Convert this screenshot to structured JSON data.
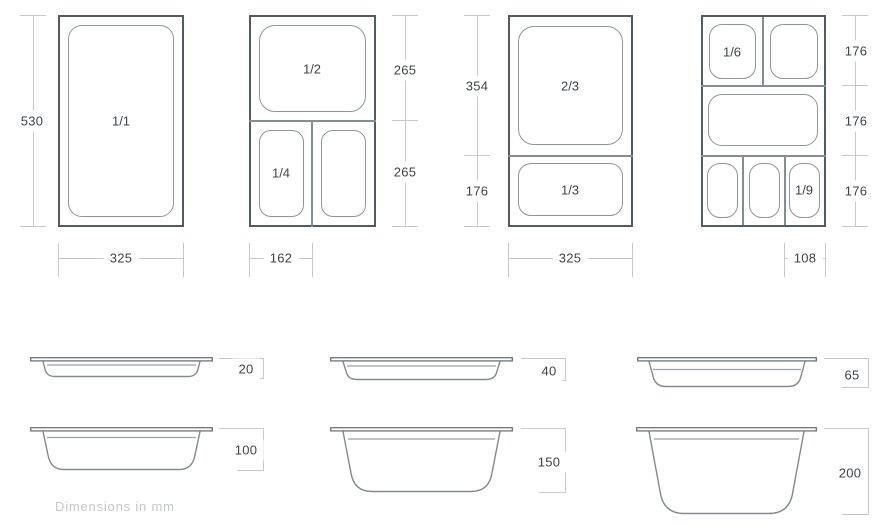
{
  "units_note": "Dimensions in mm",
  "top_views": [
    {
      "pan_labels": [
        "1/1"
      ],
      "vertical_dims": [
        "530"
      ],
      "bottom_dim": "325",
      "dim_side": "left"
    },
    {
      "pan_labels": [
        "1/2",
        "1/4"
      ],
      "vertical_dims": [
        "265",
        "265"
      ],
      "bottom_dim": "162",
      "dim_side": "right"
    },
    {
      "pan_labels": [
        "2/3",
        "1/3"
      ],
      "vertical_dims": [
        "354",
        "176"
      ],
      "bottom_dim": "325",
      "dim_side": "left"
    },
    {
      "pan_labels": [
        "1/6",
        "1/9"
      ],
      "vertical_dims": [
        "176",
        "176",
        "176"
      ],
      "bottom_dim": "108",
      "dim_side": "right"
    }
  ],
  "side_views": [
    {
      "depth": "20"
    },
    {
      "depth": "40"
    },
    {
      "depth": "65"
    },
    {
      "depth": "100"
    },
    {
      "depth": "150"
    },
    {
      "depth": "200"
    }
  ],
  "colors": {
    "background": "#ffffff",
    "frame": "#535a62",
    "divider": "#858c93",
    "pan_outline": "#8f959b",
    "dim_line": "#c7cacd",
    "label_text": "#3f444a",
    "muted_text": "#c4c7ca",
    "profile_rim": "#6e747b",
    "profile_body": "#83898f",
    "profile_ridge": "#9ba1a6"
  }
}
